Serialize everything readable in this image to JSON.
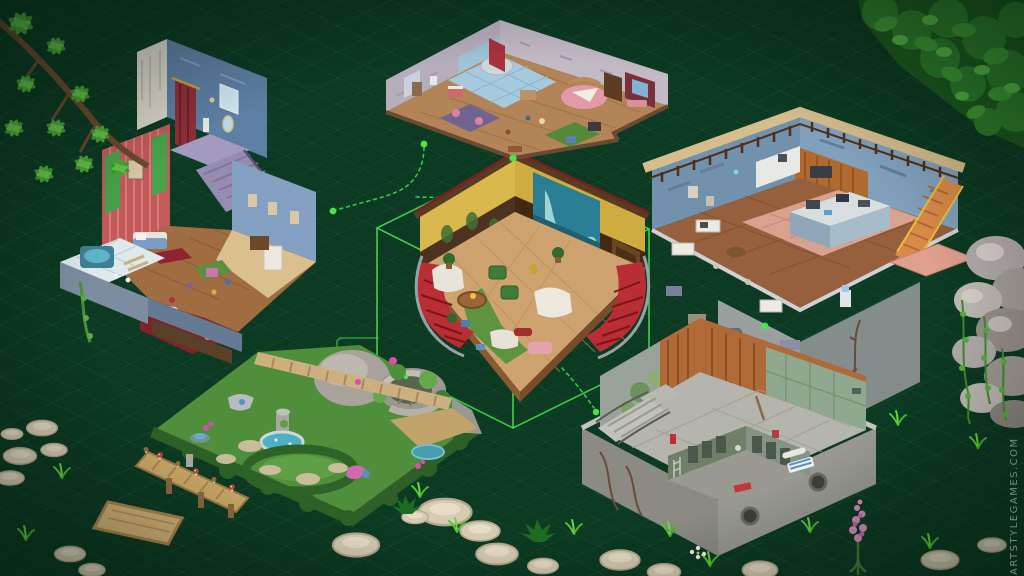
{
  "watermark": {
    "text": "ARTSTYLEGAMES.COM",
    "color": "#9fb3a5"
  },
  "palette": {
    "background": "#0c3a23",
    "background_edge": "#072c19",
    "grid": "#2f7a4c",
    "selection": "#46e050",
    "connector": "#35c948",
    "dot": "#49e649"
  },
  "map": {
    "selected_scene": "grand-hall",
    "scenes": [
      {
        "id": "manor-house",
        "position": "top-left",
        "selected": false,
        "key_colors": [
          "#c25a5a",
          "#5d7fa3",
          "#a06c42"
        ]
      },
      {
        "id": "bedroom-suite",
        "position": "top-center",
        "selected": false,
        "key_colors": [
          "#b7aebc",
          "#a6c9de",
          "#e39aa6"
        ]
      },
      {
        "id": "workshop-loft",
        "position": "right",
        "selected": false,
        "key_colors": [
          "#7291ad",
          "#d6bd8c",
          "#d8a28e"
        ]
      },
      {
        "id": "grand-hall",
        "position": "center",
        "selected": true,
        "key_colors": [
          "#d9b94d",
          "#b82e34",
          "#2a7e94"
        ]
      },
      {
        "id": "garden-fountain",
        "position": "bottom-left",
        "selected": false,
        "key_colors": [
          "#4f8f3b",
          "#a8a49c",
          "#4fb0c4"
        ]
      },
      {
        "id": "basement-pool",
        "position": "bottom-right",
        "selected": false,
        "key_colors": [
          "#9aa39a",
          "#b06a38",
          "#8fa88f"
        ]
      }
    ],
    "connector_dots": [
      {
        "x": 333,
        "y": 211
      },
      {
        "x": 424,
        "y": 144
      },
      {
        "x": 513,
        "y": 158
      },
      {
        "x": 596,
        "y": 412
      },
      {
        "x": 765,
        "y": 326
      }
    ]
  },
  "decorations": [
    "pine-branch-top-left",
    "tree-canopy-top-right",
    "rock-pile-right",
    "ivy",
    "stepping-stones",
    "grass-tufts",
    "wooden-dock",
    "mushrooms",
    "pink-lupine",
    "white-daisies"
  ]
}
